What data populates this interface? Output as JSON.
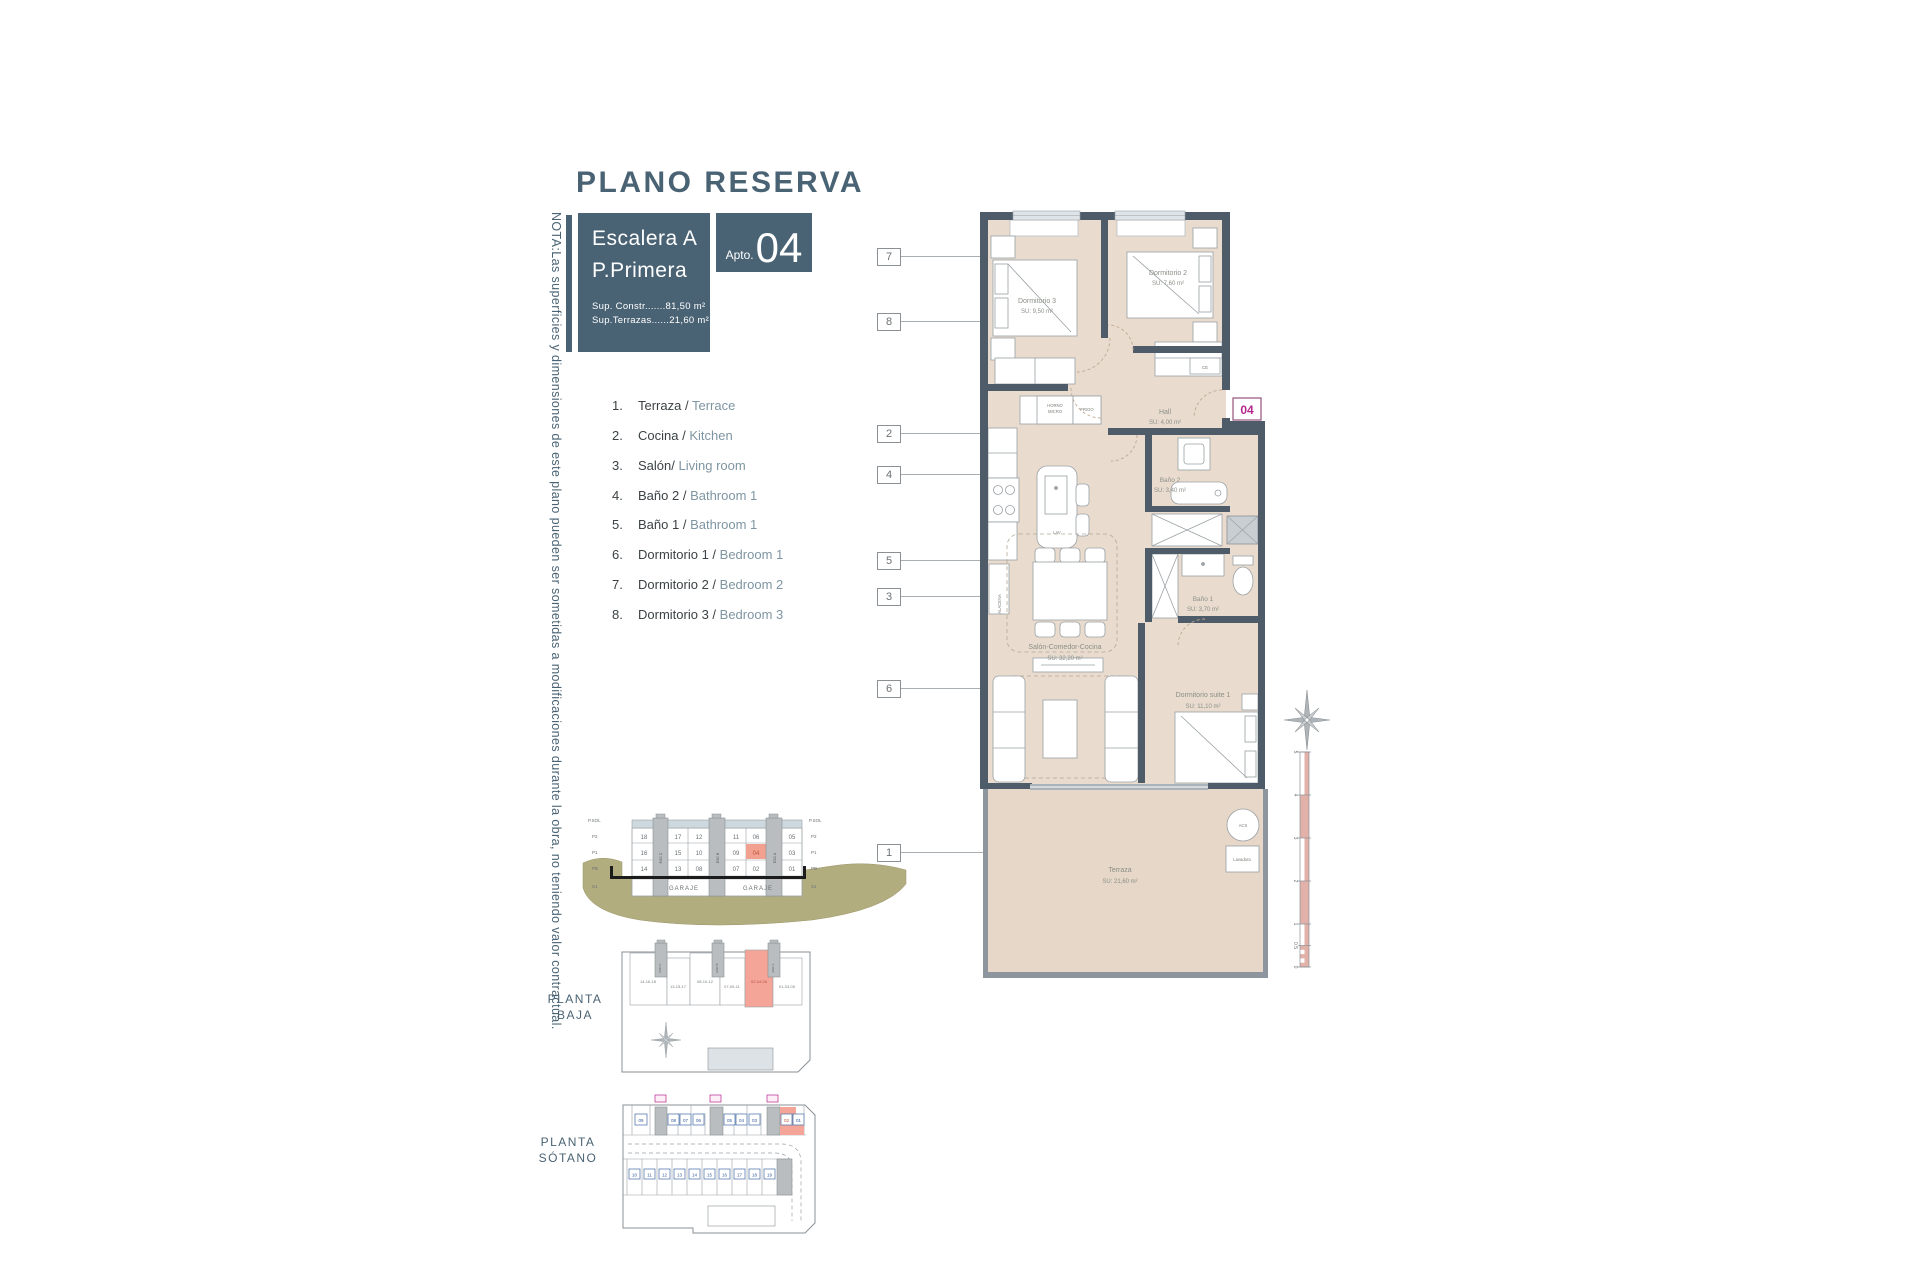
{
  "title": "PLANO RESERVA",
  "header": {
    "escalera": "Escalera A",
    "planta": "P.Primera",
    "apto_label": "Apto.",
    "apto_number": "04",
    "sup_constr": "Sup. Constr.......81,50 m²",
    "sup_terrazas": "Sup.Terrazas......21,60 m²"
  },
  "note": "NOTA:Las superficies y dimensiones de este plano pueden ser sometidas a modificaciones durante la obra, no teniendo valor contractual.",
  "legend": {
    "items": [
      {
        "num": "1.",
        "es": "Terraza /",
        "en": "Terrace"
      },
      {
        "num": "2.",
        "es": "Cocina /",
        "en": "Kitchen"
      },
      {
        "num": "3.",
        "es": "Salón/",
        "en": "Living room"
      },
      {
        "num": "4.",
        "es": "Baño 2 /",
        "en": "Bathroom 1"
      },
      {
        "num": "5.",
        "es": "Baño 1 /",
        "en": "Bathroom 1"
      },
      {
        "num": "6.",
        "es": "Dormitorio 1 /",
        "en": "Bedroom 1"
      },
      {
        "num": "7.",
        "es": "Dormitorio 2 /",
        "en": "Bedroom 2"
      },
      {
        "num": "8.",
        "es": "Dormitorio 3 /",
        "en": "Bedroom 3"
      }
    ]
  },
  "callouts": {
    "c7": "7",
    "c8": "8",
    "c2": "2",
    "c4": "4",
    "c5": "5",
    "c3": "3",
    "c6": "6",
    "c1": "1"
  },
  "plan": {
    "badge": "04",
    "rooms": {
      "dorm3": {
        "name": "Dormitorio 3",
        "area": "SU: 9,50 m²"
      },
      "dorm2": {
        "name": "Dormitorio 2",
        "area": "SU: 7,60 m²"
      },
      "hall": {
        "name": "Hall",
        "area": "SU: 4,00 m²"
      },
      "bano2": {
        "name": "Baño 2",
        "area": "SU: 3,40 m²"
      },
      "bano1": {
        "name": "Baño 1",
        "area": "SU: 3,70 m²"
      },
      "salon": {
        "name": "Salón-Comedor-Cocina",
        "area": "SU: 32,20 m²"
      },
      "suite": {
        "name": "Dormitorio suite 1",
        "area": "SU: 11,10 m²"
      },
      "terraza": {
        "name": "Terraza",
        "area": "SU: 21,60 m²"
      }
    },
    "fixtures": {
      "horno1": "HORNO",
      "horno2": "MICRO",
      "frigo": "FRIGO",
      "lav": "LAV",
      "alacena": "ALACENA",
      "ce": "CE",
      "acs": "ACS",
      "lavadora": "Lavadora"
    }
  },
  "section": {
    "floors_left": [
      "P.SOL",
      "P2",
      "P1",
      "PB",
      "S1"
    ],
    "floors_right": [
      "P.SOL",
      "P2",
      "P1",
      "PB",
      "S1"
    ],
    "row_p2": [
      "18",
      "17",
      "12",
      "11",
      "06",
      "05"
    ],
    "row_p1": [
      "16",
      "15",
      "10",
      "09",
      "04",
      "03"
    ],
    "row_pb": [
      "14",
      "13",
      "08",
      "07",
      "02",
      "01"
    ],
    "garaje1": "GARAJE",
    "garaje2": "GARAJE",
    "esc": [
      "ESC C",
      "ESC B",
      "ESC A"
    ]
  },
  "planta_baja": {
    "label1": "PLANTA",
    "label2": "BAJA",
    "cells": [
      "14-16-18",
      "13-15-17",
      "08-10-12",
      "07-09-11",
      "02-04-06",
      "01-03-05"
    ]
  },
  "planta_sotano": {
    "label1": "PLANTA",
    "label2": "SÓTANO",
    "storage": [
      "09",
      "08",
      "07",
      "06",
      "05",
      "04",
      "03",
      "02",
      "01"
    ],
    "parking": [
      "10",
      "11",
      "12",
      "13",
      "14",
      "15",
      "16",
      "17",
      "18",
      "19"
    ]
  },
  "scale_bar": {
    "ticks": [
      "5",
      "4",
      "3",
      "2",
      "1",
      "0.5",
      "0"
    ]
  },
  "colors": {
    "slate": "#4a6374",
    "wall": "#4e5c6a",
    "floor": "#e9dccf",
    "highlight": "#f2a08f",
    "magenta": "#b5268c",
    "ground": "#b2ad7f",
    "blue_num": "#31599c"
  }
}
